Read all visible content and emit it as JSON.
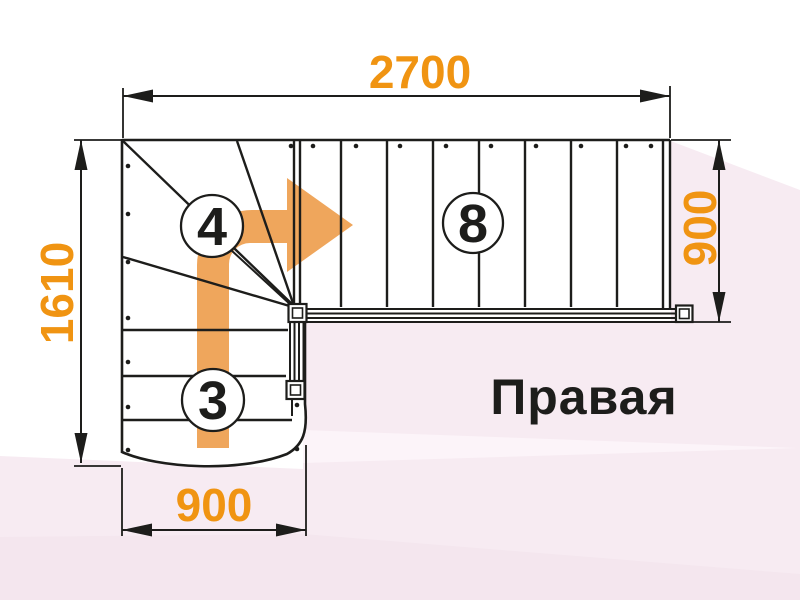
{
  "title": "Правая",
  "dimensions": {
    "top_width": "2700",
    "left_height": "1610",
    "right_flight_width": "900",
    "bottom_flight_width": "900"
  },
  "step_counts": {
    "upper_straight_flight": "8",
    "winder_steps": "4",
    "lower_flight": "3"
  },
  "colors": {
    "dimension_text": "#f09412",
    "arrow_fill": "#efa65c",
    "line": "#1d1d1b",
    "background_pink_main": "#f7ebf2",
    "background_pink_light": "#fcf4f9",
    "background_pink_deep": "#f4e6ee",
    "stair_fill": "#ffffff"
  }
}
